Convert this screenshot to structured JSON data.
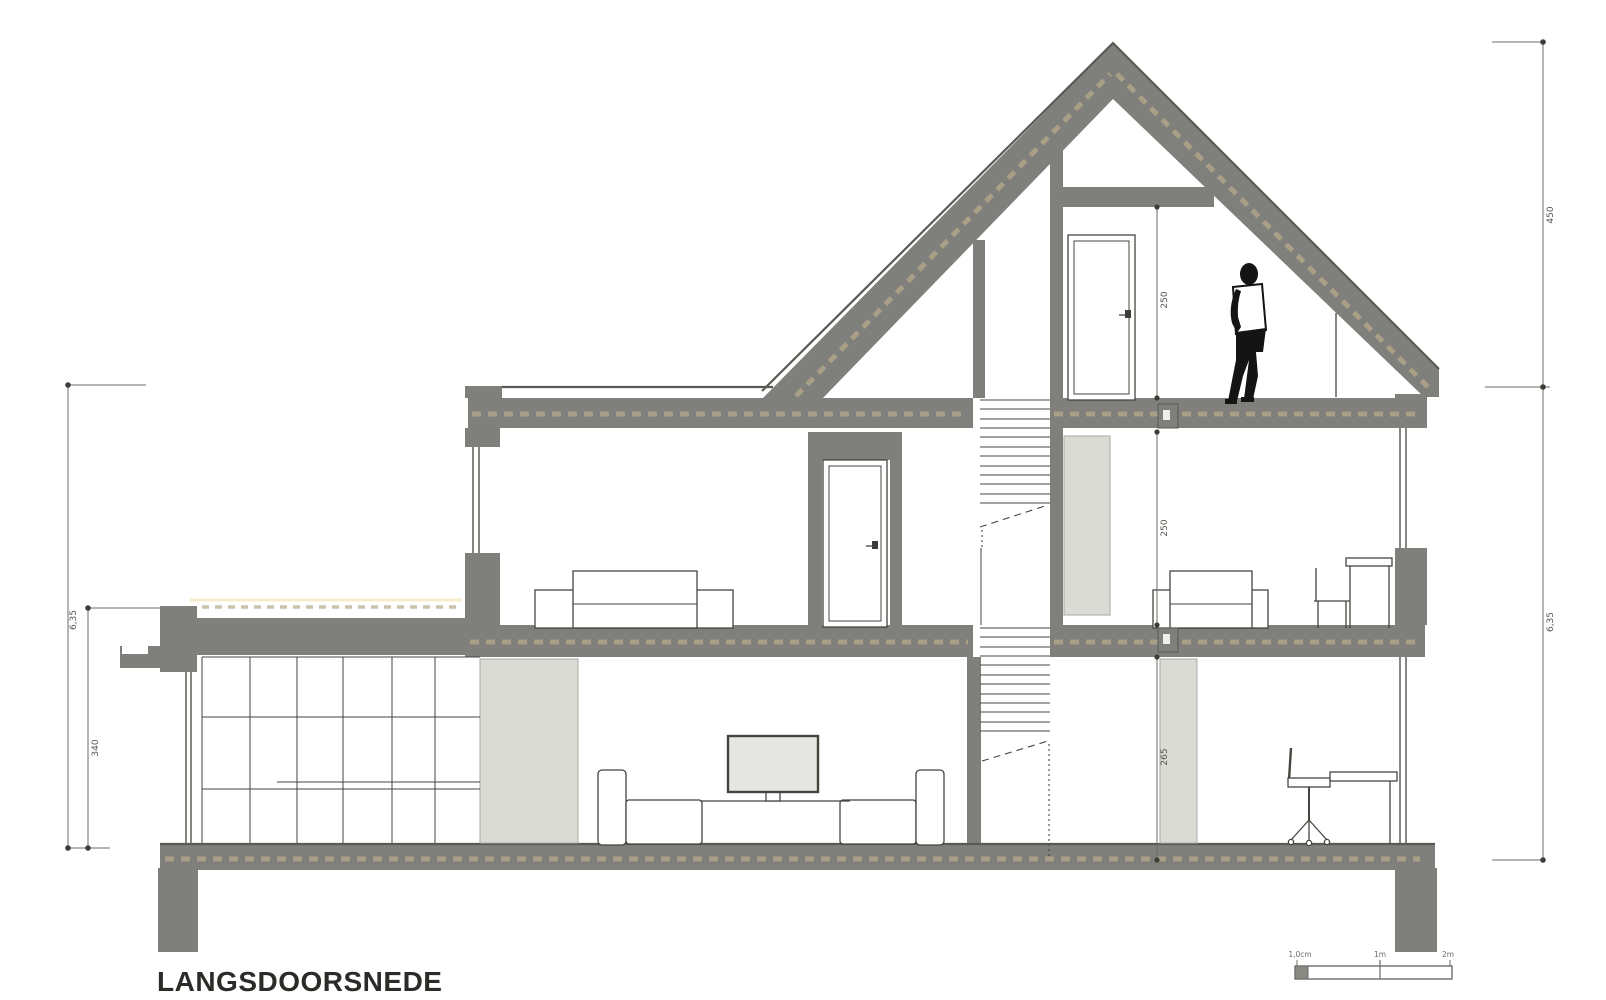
{
  "title": {
    "text": "LANGSDOORSNEDE"
  },
  "colors": {
    "background": "#ffffff",
    "wall": "#7f7f7b",
    "wall_edge": "#5a5a55",
    "light_block": "#dbdbd5",
    "insulation": "#b4a88a",
    "cream": "#f4ecca",
    "line": "#45453f",
    "figure": "#141414",
    "tv_screen": "#e6e6e2"
  },
  "dimensions": {
    "left_total": "6,35",
    "left_extension": "340",
    "right_roof": "450",
    "right_total": "6,35",
    "attic_height": "250",
    "first_floor_height": "250",
    "ground_floor_height": "265"
  },
  "scale_bar": {
    "label_start": "1,0cm",
    "label_mid": "1m",
    "label_end": "2m"
  }
}
